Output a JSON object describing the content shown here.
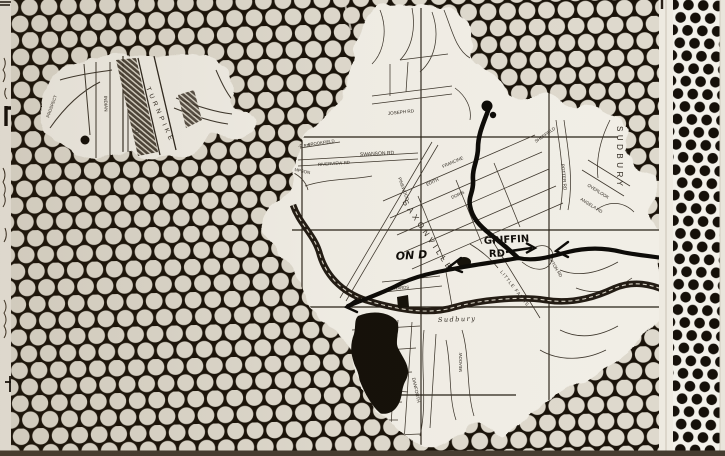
{
  "artwork": {
    "left_fragment": {
      "labels": {
        "prospect": "PROSPECT",
        "indian": "INDIAN",
        "turnpike": "TURNPIKE",
        "st": "ST"
      }
    },
    "map": {
      "labels": {
        "david": "DAVID RD",
        "brookfield": "BROOKFIELD",
        "riverview": "RIVERVIEW RD",
        "simpson": "SIMPSON",
        "swanson": "SWANSON RD",
        "joseph": "JOSEPH RD",
        "sheffield": "SHEFFIELD",
        "saxonville": "SAXONVILLE",
        "francine": "FRANCINE",
        "edith": "EDITH",
        "doris": "DORIS",
        "pinewood": "PINEWOOD",
        "sudbury_town": "SUDBURY",
        "potter": "POTTER RD",
        "overlook": "OVERLOOK",
        "angela": "ANGELA RD",
        "little_farms": "LITTLE FARMS",
        "upton": "UPTON RD",
        "edwards": "EDWARDS",
        "meadow": "MEADOW",
        "danforth": "DANFORTH",
        "river": "Sudbury"
      },
      "annotations": {
        "griffin_line1": "GRIFFIN",
        "griffin_line2": "RD",
        "note": "ON D"
      }
    },
    "colors": {
      "panel_black": "#191209",
      "dot_cream": "#ded9cd",
      "map_paper": "#f1eee6",
      "strip_paper": "#f3f1ea",
      "strip_dot": "#151009",
      "route_ink": "#0c0a07",
      "photo_edge": "#463c30"
    }
  }
}
